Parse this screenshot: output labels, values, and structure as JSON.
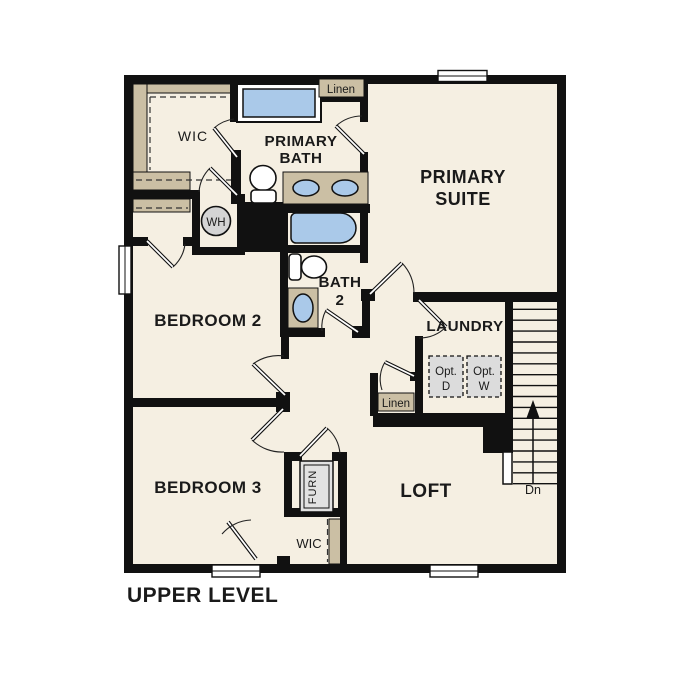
{
  "title": "UPPER LEVEL",
  "rooms": {
    "primary_suite": {
      "line1": "PRIMARY",
      "line2": "SUITE"
    },
    "primary_bath": {
      "line1": "PRIMARY",
      "line2": "BATH"
    },
    "bath_2": {
      "line1": "BATH",
      "line2": "2"
    },
    "bedroom_2": {
      "label": "BEDROOM 2"
    },
    "bedroom_3": {
      "label": "BEDROOM 3"
    },
    "loft": {
      "label": "LOFT"
    },
    "laundry": {
      "label": "LAUNDRY"
    },
    "wic_primary": {
      "label": "WIC"
    },
    "wic_bedroom3": {
      "label": "WIC"
    }
  },
  "closets": {
    "linen_bath": {
      "label": "Linen"
    },
    "linen_hall": {
      "label": "Linen"
    }
  },
  "equipment": {
    "water_heater": {
      "label": "WH"
    },
    "furnace": {
      "label": "FURN"
    },
    "optional_dryer": {
      "line1": "Opt.",
      "line2": "D"
    },
    "optional_washer": {
      "line1": "Opt.",
      "line2": "W"
    }
  },
  "stairs": {
    "direction_label": "Dn"
  },
  "colors": {
    "background": "#ffffff",
    "floor": "#f5efe2",
    "wall": "#111111",
    "closet_shelf_tan": "#cbbfa4",
    "fixture_blue": "#aac9e9",
    "equipment_gray": "#dcdcdc",
    "text": "#1a1a1a"
  }
}
